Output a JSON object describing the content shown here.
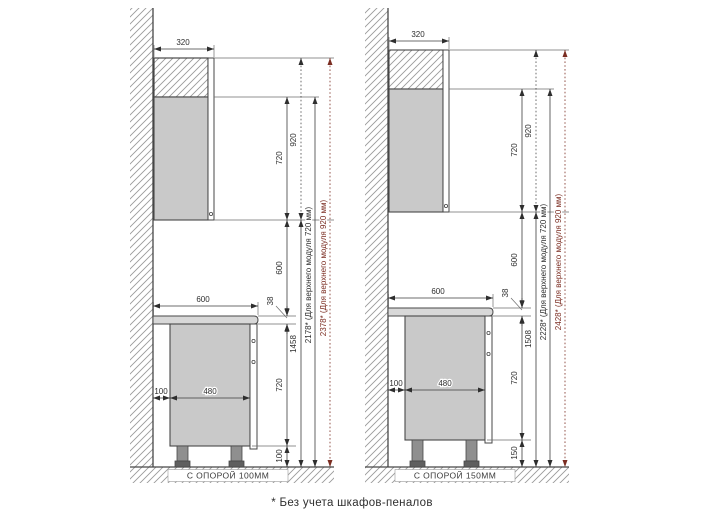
{
  "footnote": "* Без учета шкафов-пеналов",
  "colors": {
    "line": "#474747",
    "dimension": "#2e2e2e",
    "accent_red": "#7b2d22",
    "cabinet_fill": "#c9c9c9",
    "countertop_fill": "#d8d8d8"
  },
  "left": {
    "support_label": "С ОПОРОЙ 100ММ",
    "upper_depth": "320",
    "upper_height_720": "720",
    "upper_height_920": "920",
    "gap_to_countertop": "600",
    "countertop_thickness": "38",
    "countertop_depth": "600",
    "base_body_height": "720",
    "wall_clearance": "100",
    "base_body_depth": "480",
    "support_height": "100",
    "floor_to_upper_cabinet": "1458",
    "total_height_720": "2178* (Для верхнего модуля 720 мм)",
    "total_height_920": "2378* (Для верхнего модуля 920 мм)"
  },
  "right": {
    "support_label": "С ОПОРОЙ 150ММ",
    "upper_depth": "320",
    "upper_height_720": "720",
    "upper_height_920": "920",
    "gap_to_countertop": "600",
    "countertop_thickness": "38",
    "countertop_depth": "600",
    "base_body_height": "720",
    "wall_clearance": "100",
    "base_body_depth": "480",
    "support_height": "150",
    "floor_to_upper_cabinet": "1508",
    "total_height_720": "2228* (Для верхнего модуля 720 мм)",
    "total_height_920": "2428* (Для верхнего модуля 920 мм)"
  }
}
